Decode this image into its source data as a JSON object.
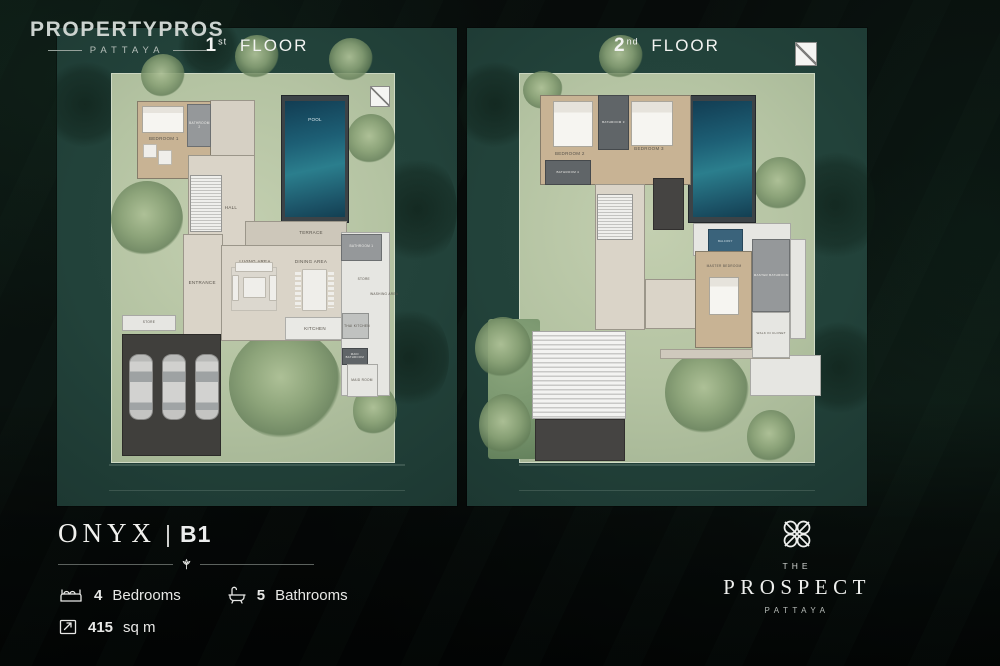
{
  "brand": {
    "name": "PROPERTYPROS",
    "sub": "PATTAYA"
  },
  "colors": {
    "panel_teal": "#22423a",
    "grass_green": "#b4c3a2",
    "pool_blue": "#2b7e8d",
    "background": "#070b0a",
    "text": "#eceded"
  },
  "plans": [
    {
      "title": {
        "number": "1",
        "ordinal": "st",
        "word": "FLOOR"
      },
      "elements": [
        {
          "t": "treedark",
          "x": -2,
          "y": 6,
          "w": 18,
          "h": 20
        },
        {
          "t": "treedark",
          "x": 80,
          "y": 26,
          "w": 20,
          "h": 24
        },
        {
          "t": "treedark",
          "x": 78,
          "y": 58,
          "w": 20,
          "h": 22
        },
        {
          "t": "treedark",
          "x": 30,
          "y": -2,
          "w": 16,
          "h": 12
        },
        {
          "t": "grass",
          "x": 13.5,
          "y": 9.5,
          "w": 71,
          "h": 81.5
        },
        {
          "t": "tree",
          "x": 13.5,
          "y": 32,
          "w": 18,
          "h": 16
        },
        {
          "t": "tree",
          "x": 21,
          "y": 5.5,
          "w": 11,
          "h": 9
        },
        {
          "t": "tree",
          "x": 44.5,
          "y": 1.5,
          "w": 11,
          "h": 9
        },
        {
          "t": "tree",
          "x": 68,
          "y": 2,
          "w": 11,
          "h": 9
        },
        {
          "t": "tree",
          "x": 72.5,
          "y": 18,
          "w": 12,
          "h": 10.5
        },
        {
          "t": "tree",
          "x": 43,
          "y": 63,
          "w": 28,
          "h": 23
        },
        {
          "t": "tree",
          "x": 74,
          "y": 74.5,
          "w": 11,
          "h": 11
        },
        {
          "t": "road",
          "x": 13,
          "y": 91.2,
          "w": 74,
          "h": 0.35
        },
        {
          "t": "road",
          "x": 13,
          "y": 96.6,
          "w": 74,
          "h": 0.35
        },
        {
          "t": "mark",
          "x": 78.3,
          "y": 12.2,
          "w": 5,
          "h": 4.4
        },
        {
          "t": "poolrim",
          "x": 56,
          "y": 14,
          "w": 17,
          "h": 26.8
        },
        {
          "t": "pool",
          "x": 57.1,
          "y": 15.2,
          "w": 14.8,
          "h": 24.4
        },
        {
          "t": "labelw",
          "x": 57.5,
          "y": 17.6,
          "w": 14,
          "h": 3,
          "l": "POOL"
        },
        {
          "t": "walk",
          "x": 38.3,
          "y": 15,
          "w": 11.3,
          "h": 12
        },
        {
          "t": "wood",
          "x": 20,
          "y": 15.3,
          "w": 18.6,
          "h": 16.2
        },
        {
          "t": "bath",
          "x": 32.6,
          "y": 15.8,
          "w": 6,
          "h": 9.2,
          "l": "BATHROOM 2",
          "fs": 3.2
        },
        {
          "t": "bed",
          "x": 21.3,
          "y": 16.3,
          "w": 10.4,
          "h": 5.6
        },
        {
          "t": "furn",
          "x": 21.5,
          "y": 24.3,
          "w": 3.4,
          "h": 3
        },
        {
          "t": "furn",
          "x": 25.3,
          "y": 25.6,
          "w": 3.4,
          "h": 3
        },
        {
          "t": "label",
          "x": 20.7,
          "y": 21.8,
          "w": 12,
          "h": 2.6,
          "l": "BEDROOM 1"
        },
        {
          "t": "floor",
          "x": 32.8,
          "y": 26.5,
          "w": 16.6,
          "h": 20
        },
        {
          "t": "stairs",
          "x": 33.2,
          "y": 30.8,
          "w": 8,
          "h": 11.8
        },
        {
          "t": "label",
          "x": 38.5,
          "y": 36.3,
          "w": 10,
          "h": 2.6,
          "l": "HALL"
        },
        {
          "t": "terrace",
          "x": 47,
          "y": 40.3,
          "w": 25.6,
          "h": 5.3
        },
        {
          "t": "label",
          "x": 57.5,
          "y": 41.6,
          "w": 12,
          "h": 2.6,
          "l": "TERRACE"
        },
        {
          "t": "floor",
          "x": 31.5,
          "y": 43,
          "w": 10,
          "h": 22.4
        },
        {
          "t": "label",
          "x": 30.8,
          "y": 52,
          "w": 11,
          "h": 2.6,
          "l": "ENTRANCE"
        },
        {
          "t": "floor",
          "x": 41,
          "y": 45.4,
          "w": 31.6,
          "h": 20
        },
        {
          "t": "label",
          "x": 43,
          "y": 47.6,
          "w": 13,
          "h": 2.6,
          "l": "LIVING AREA"
        },
        {
          "t": "label",
          "x": 57,
          "y": 47.6,
          "w": 13,
          "h": 2.6,
          "l": "DINING AREA"
        },
        {
          "t": "furnrug",
          "x": 43.5,
          "y": 50,
          "w": 11.5,
          "h": 9.2
        },
        {
          "t": "furn",
          "x": 44.6,
          "y": 49,
          "w": 9.4,
          "h": 2
        },
        {
          "t": "furn",
          "x": 43.7,
          "y": 51.6,
          "w": 1.9,
          "h": 5.6
        },
        {
          "t": "furn",
          "x": 53.1,
          "y": 51.6,
          "w": 1.9,
          "h": 5.6
        },
        {
          "t": "furn",
          "x": 46.6,
          "y": 52,
          "w": 5.6,
          "h": 4.4
        },
        {
          "t": "chairs",
          "x": 59.5,
          "y": 51,
          "w": 1.5,
          "h": 7.6
        },
        {
          "t": "chairs",
          "x": 67.8,
          "y": 51,
          "w": 1.5,
          "h": 7.6
        },
        {
          "t": "furn",
          "x": 61.2,
          "y": 50.4,
          "w": 6.4,
          "h": 8.8
        },
        {
          "t": "counter",
          "x": 57,
          "y": 60.4,
          "w": 15.6,
          "h": 4.9
        },
        {
          "t": "label",
          "x": 58.5,
          "y": 61.6,
          "w": 12,
          "h": 2.6,
          "l": "KITCHEN"
        },
        {
          "t": "service",
          "x": 71,
          "y": 42.6,
          "w": 12.2,
          "h": 34.4
        },
        {
          "t": "bath",
          "x": 71,
          "y": 43,
          "w": 10.2,
          "h": 5.8,
          "l": "BATHROOM 1",
          "fs": 3.2
        },
        {
          "t": "label",
          "x": 72.9,
          "y": 51.6,
          "w": 7.6,
          "h": 2.4,
          "l": "STORE",
          "fs": 3.2
        },
        {
          "t": "label",
          "x": 77.8,
          "y": 53.6,
          "w": 8,
          "h": 4.5,
          "l": "WASHING AREA",
          "fs": 3.2
        },
        {
          "t": "bathlite",
          "x": 71.2,
          "y": 59.6,
          "w": 6.9,
          "h": 5.4
        },
        {
          "t": "label",
          "x": 70,
          "y": 61.2,
          "w": 10,
          "h": 2.6,
          "l": "THAI KITCHEN",
          "fs": 3.2
        },
        {
          "t": "bathdark",
          "x": 71.2,
          "y": 66.9,
          "w": 6.5,
          "h": 3.6,
          "l": "MAID BATHROOM",
          "fs": 2.8
        },
        {
          "t": "service",
          "x": 72.5,
          "y": 70.3,
          "w": 7.7,
          "h": 6.8
        },
        {
          "t": "label",
          "x": 71.5,
          "y": 72.6,
          "w": 9.5,
          "h": 2.6,
          "l": "MAID ROOM",
          "fs": 3.2
        },
        {
          "t": "service",
          "x": 16.2,
          "y": 60,
          "w": 13.6,
          "h": 3.4
        },
        {
          "t": "label",
          "x": 18.5,
          "y": 60.3,
          "w": 9,
          "h": 2.6,
          "l": "STORE",
          "fs": 3.2
        },
        {
          "t": "park",
          "x": 16.2,
          "y": 64,
          "w": 24.8,
          "h": 25.6
        },
        {
          "t": "car",
          "x": 18,
          "y": 68.3,
          "w": 5.9,
          "h": 13.7
        },
        {
          "t": "car",
          "x": 26.3,
          "y": 68.3,
          "w": 5.9,
          "h": 13.7
        },
        {
          "t": "car",
          "x": 34.6,
          "y": 68.3,
          "w": 5.9,
          "h": 13.7
        }
      ]
    },
    {
      "title": {
        "number": "2",
        "ordinal": "nd",
        "word": "FLOOR"
      },
      "elements": [
        {
          "t": "treedark",
          "x": -2,
          "y": 6,
          "w": 18,
          "h": 20
        },
        {
          "t": "treedark",
          "x": 82,
          "y": 24,
          "w": 20,
          "h": 26
        },
        {
          "t": "treedark",
          "x": 84,
          "y": 60,
          "w": 18,
          "h": 22
        },
        {
          "t": "grass",
          "x": 13,
          "y": 9.5,
          "w": 74,
          "h": 81.5
        },
        {
          "t": "hedge",
          "x": 5.3,
          "y": 60.8,
          "w": 13,
          "h": 29.4
        },
        {
          "t": "tree",
          "x": 2,
          "y": 60.5,
          "w": 14,
          "h": 13
        },
        {
          "t": "tree",
          "x": 3,
          "y": 76.5,
          "w": 13,
          "h": 13
        },
        {
          "t": "tree",
          "x": 33,
          "y": 1.5,
          "w": 11,
          "h": 9
        },
        {
          "t": "tree",
          "x": 14,
          "y": 9,
          "w": 10,
          "h": 8
        },
        {
          "t": "tree",
          "x": 71.8,
          "y": 27,
          "w": 13,
          "h": 11
        },
        {
          "t": "tree",
          "x": 49.5,
          "y": 67.5,
          "w": 21,
          "h": 17.5
        },
        {
          "t": "tree",
          "x": 70,
          "y": 80,
          "w": 12,
          "h": 11
        },
        {
          "t": "road",
          "x": 13,
          "y": 91.2,
          "w": 74,
          "h": 0.35
        },
        {
          "t": "road",
          "x": 13,
          "y": 96.6,
          "w": 74,
          "h": 0.35
        },
        {
          "t": "mark",
          "x": 82,
          "y": 2.9,
          "w": 5.6,
          "h": 5
        },
        {
          "t": "poolrim",
          "x": 55.3,
          "y": 14,
          "w": 17,
          "h": 26.8
        },
        {
          "t": "pool",
          "x": 56.4,
          "y": 15.2,
          "w": 14.8,
          "h": 24.4
        },
        {
          "t": "roof",
          "x": 16.3,
          "y": 63.3,
          "w": 23.4,
          "h": 18.4
        },
        {
          "t": "paved",
          "x": 17,
          "y": 81.7,
          "w": 22.6,
          "h": 8.8
        },
        {
          "t": "service",
          "x": 70.8,
          "y": 68.5,
          "w": 17.6,
          "h": 8.4
        },
        {
          "t": "floor2",
          "x": 48.3,
          "y": 67.1,
          "w": 32.5,
          "h": 2.1
        },
        {
          "t": "wood",
          "x": 18.3,
          "y": 14,
          "w": 37.6,
          "h": 18.8
        },
        {
          "t": "bathdark",
          "x": 32.8,
          "y": 14,
          "w": 7.6,
          "h": 11.6,
          "l": "BATHROOM 3",
          "fs": 3
        },
        {
          "t": "bathdark",
          "x": 19.5,
          "y": 27.6,
          "w": 11.4,
          "h": 5.3,
          "l": "BATHROOM 4",
          "fs": 3
        },
        {
          "t": "bed",
          "x": 21.5,
          "y": 15.2,
          "w": 10,
          "h": 9.8
        },
        {
          "t": "bed",
          "x": 41,
          "y": 15.2,
          "w": 10.5,
          "h": 9.4
        },
        {
          "t": "label",
          "x": 19.7,
          "y": 25,
          "w": 12,
          "h": 2.6,
          "l": "BEDROOM 2"
        },
        {
          "t": "label",
          "x": 39.5,
          "y": 24,
          "w": 12,
          "h": 2.6,
          "l": "BEDROOM 3"
        },
        {
          "t": "floor",
          "x": 32,
          "y": 32.7,
          "w": 12.6,
          "h": 30.4
        },
        {
          "t": "stairs",
          "x": 32.6,
          "y": 34.8,
          "w": 9,
          "h": 9.6
        },
        {
          "t": "paved",
          "x": 46.4,
          "y": 31.3,
          "w": 7.8,
          "h": 10.9
        },
        {
          "t": "floor",
          "x": 44.5,
          "y": 52.5,
          "w": 14,
          "h": 10.5
        },
        {
          "t": "service",
          "x": 56.5,
          "y": 40.8,
          "w": 24.5,
          "h": 6.8
        },
        {
          "t": "balcony",
          "x": 60.3,
          "y": 42,
          "w": 8.6,
          "h": 5.4,
          "l": "BALCONY",
          "fs": 2.6
        },
        {
          "t": "wood",
          "x": 57,
          "y": 46.7,
          "w": 14.3,
          "h": 20.3
        },
        {
          "t": "label",
          "x": 58,
          "y": 48.6,
          "w": 12.5,
          "h": 2.6,
          "l": "MASTER BEDROOM",
          "fs": 3.2
        },
        {
          "t": "bed",
          "x": 60.5,
          "y": 52,
          "w": 7.5,
          "h": 8
        },
        {
          "t": "bath",
          "x": 71.3,
          "y": 44.2,
          "w": 9.5,
          "h": 15.2,
          "l": "MASTER BATHROOM",
          "fs": 3
        },
        {
          "t": "service",
          "x": 71.3,
          "y": 59.4,
          "w": 9.5,
          "h": 9.6
        },
        {
          "t": "label",
          "x": 71.3,
          "y": 61.5,
          "w": 9.5,
          "h": 5,
          "l": "WALK IN CLOSET",
          "fs": 3
        },
        {
          "t": "service",
          "x": 80.8,
          "y": 44.2,
          "w": 4,
          "h": 20.8
        }
      ]
    }
  ],
  "unit": {
    "name": "ONYX",
    "sep": "|",
    "code": "B1",
    "specs": [
      {
        "icon": "bed-icon",
        "value": "4",
        "label": "Bedrooms"
      },
      {
        "icon": "bath-icon",
        "value": "5",
        "label": "Bathrooms"
      },
      {
        "icon": "area-icon",
        "value": "415",
        "label": "sq m"
      }
    ]
  },
  "developer": {
    "pre": "THE",
    "name": "PROSPECT",
    "sub": "PATTAYA"
  }
}
